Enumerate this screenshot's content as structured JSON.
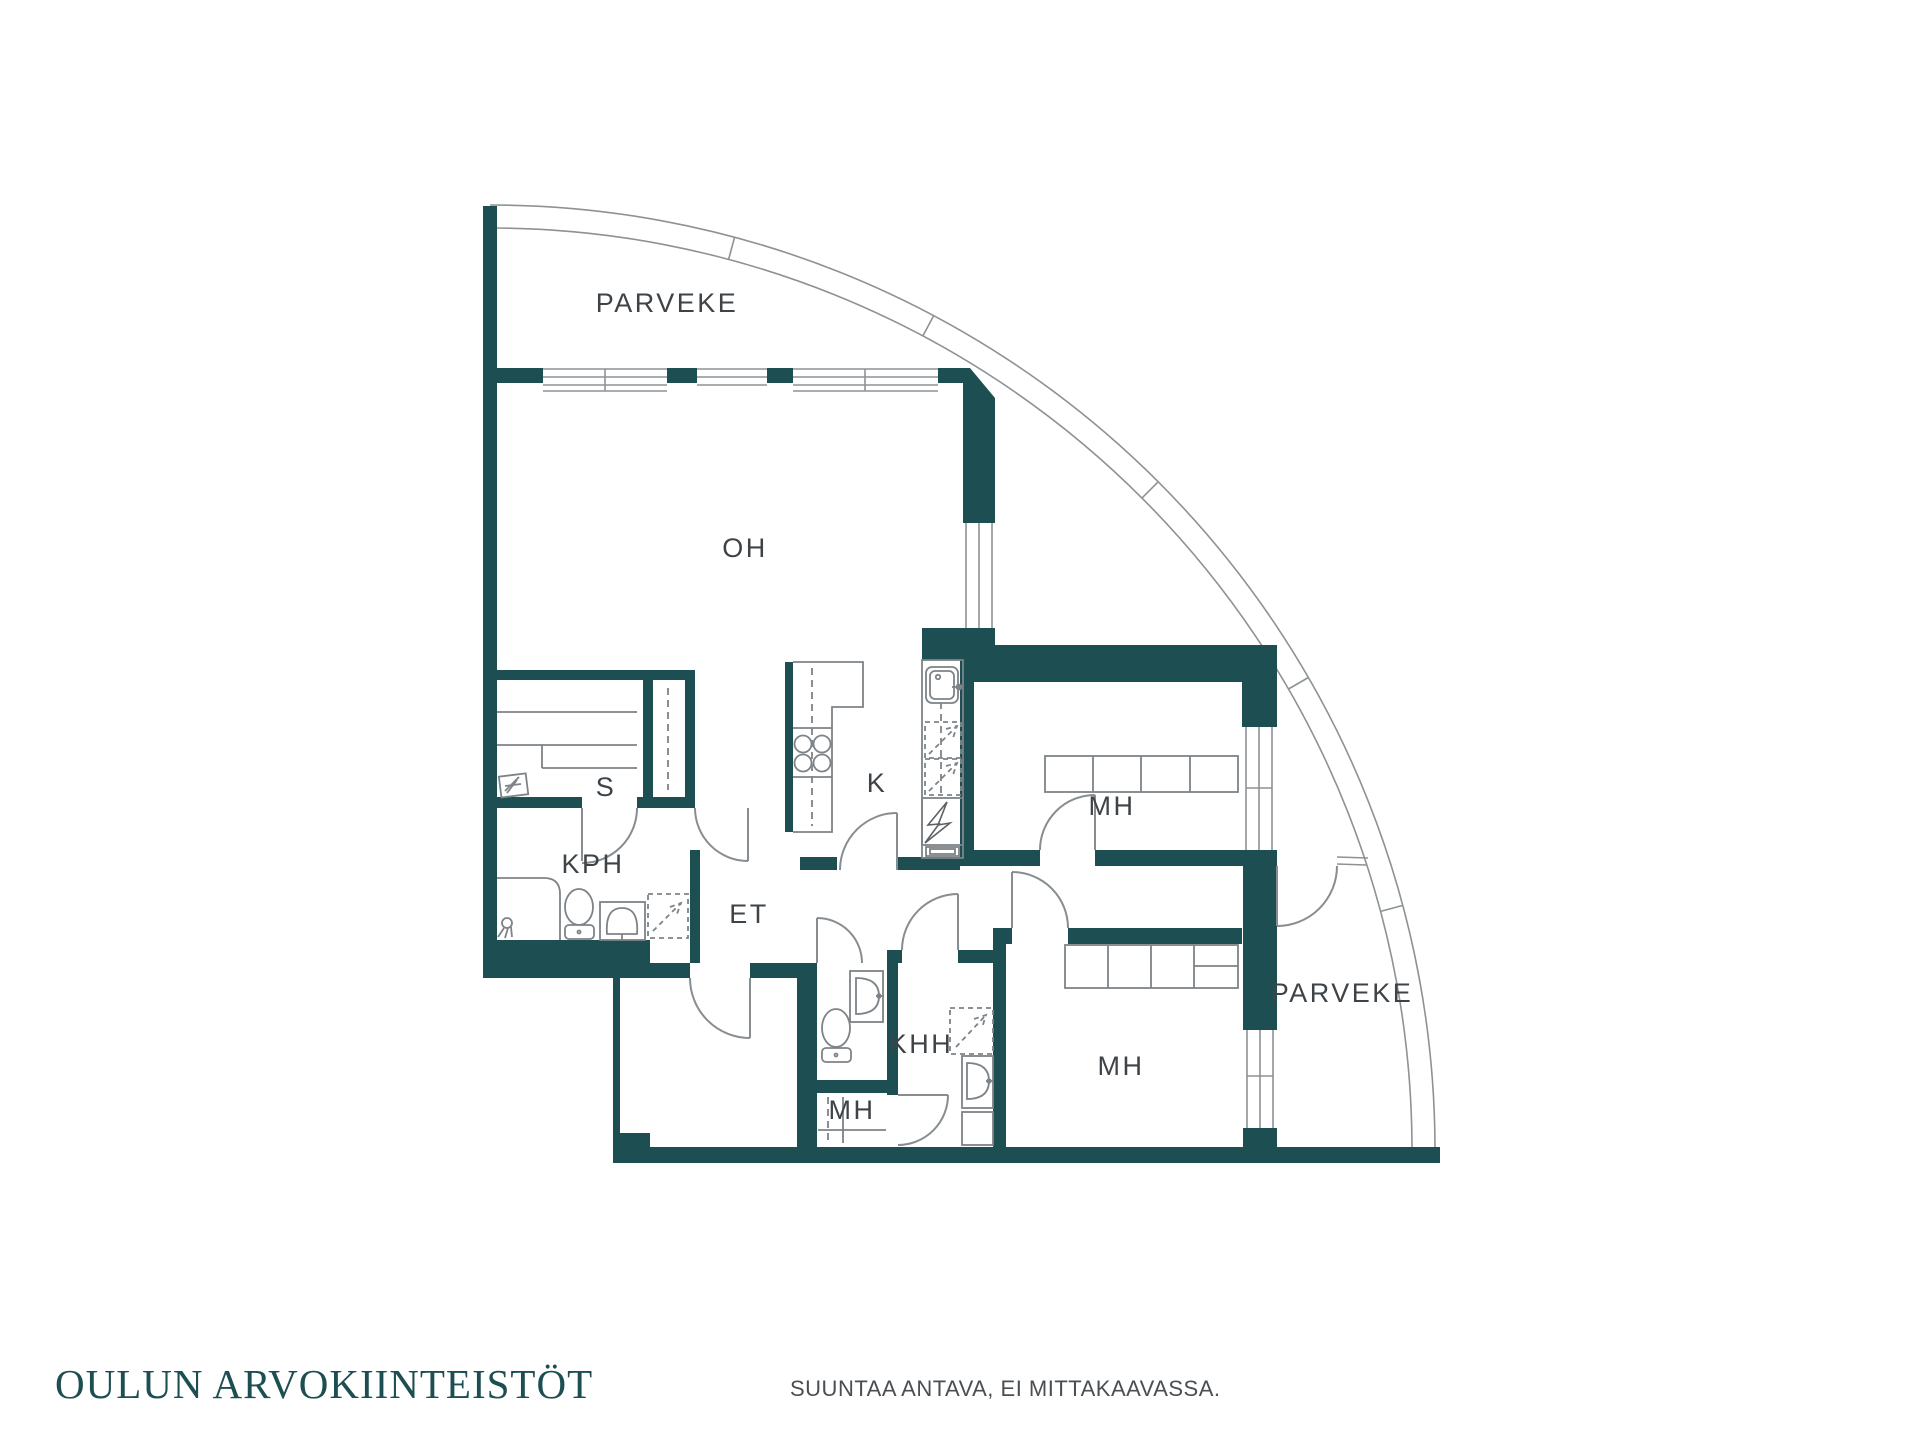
{
  "page": {
    "background": "#ffffff",
    "type": "floor-plan-sheet"
  },
  "branding": {
    "logo_text": "OULUN ARVOKIINTEISTÖT",
    "logo_color": "#1d4f52"
  },
  "footer": {
    "disclaimer": "SUUNTAA ANTAVA, EI MITTAKAAVASSA."
  },
  "floorplan": {
    "wall_color": "#1d4f52",
    "line_color": "#878d90",
    "fixture_line_color": "#7d8387",
    "label_color": "#3d4347",
    "rooms": [
      {
        "id": "parveke-top",
        "label": "PARVEKE"
      },
      {
        "id": "oh",
        "label": "OH"
      },
      {
        "id": "s",
        "label": "S"
      },
      {
        "id": "kph",
        "label": "KPH"
      },
      {
        "id": "et",
        "label": "ET"
      },
      {
        "id": "k",
        "label": "K"
      },
      {
        "id": "mh-top-right",
        "label": "MH"
      },
      {
        "id": "khh",
        "label": "KHH"
      },
      {
        "id": "mh-small",
        "label": "MH"
      },
      {
        "id": "mh-bottom-right",
        "label": "MH"
      },
      {
        "id": "parveke-right",
        "label": "PARVEKE"
      }
    ],
    "fixtures": [
      {
        "name": "shower-icon",
        "room": "KPH"
      },
      {
        "name": "toilet-icon",
        "room": "KPH"
      },
      {
        "name": "sink-icon",
        "room": "KPH"
      },
      {
        "name": "washing-machine-icon",
        "room": "KPH"
      },
      {
        "name": "sauna-heater-icon",
        "room": "S"
      },
      {
        "name": "sauna-benches",
        "room": "S"
      },
      {
        "name": "stove-icon",
        "room": "K"
      },
      {
        "name": "kitchen-sink-icon",
        "room": "K"
      },
      {
        "name": "dishwasher-icon",
        "room": "K"
      },
      {
        "name": "electrical-panel-icon",
        "room": "K"
      },
      {
        "name": "toilet-icon",
        "room": "WC"
      },
      {
        "name": "sink-icon",
        "room": "WC"
      },
      {
        "name": "washing-machine-icon",
        "room": "KHH"
      },
      {
        "name": "sink-icon",
        "room": "KHH"
      },
      {
        "name": "wardrobe",
        "room": "MH top"
      },
      {
        "name": "wardrobe",
        "room": "MH bottom"
      }
    ]
  }
}
